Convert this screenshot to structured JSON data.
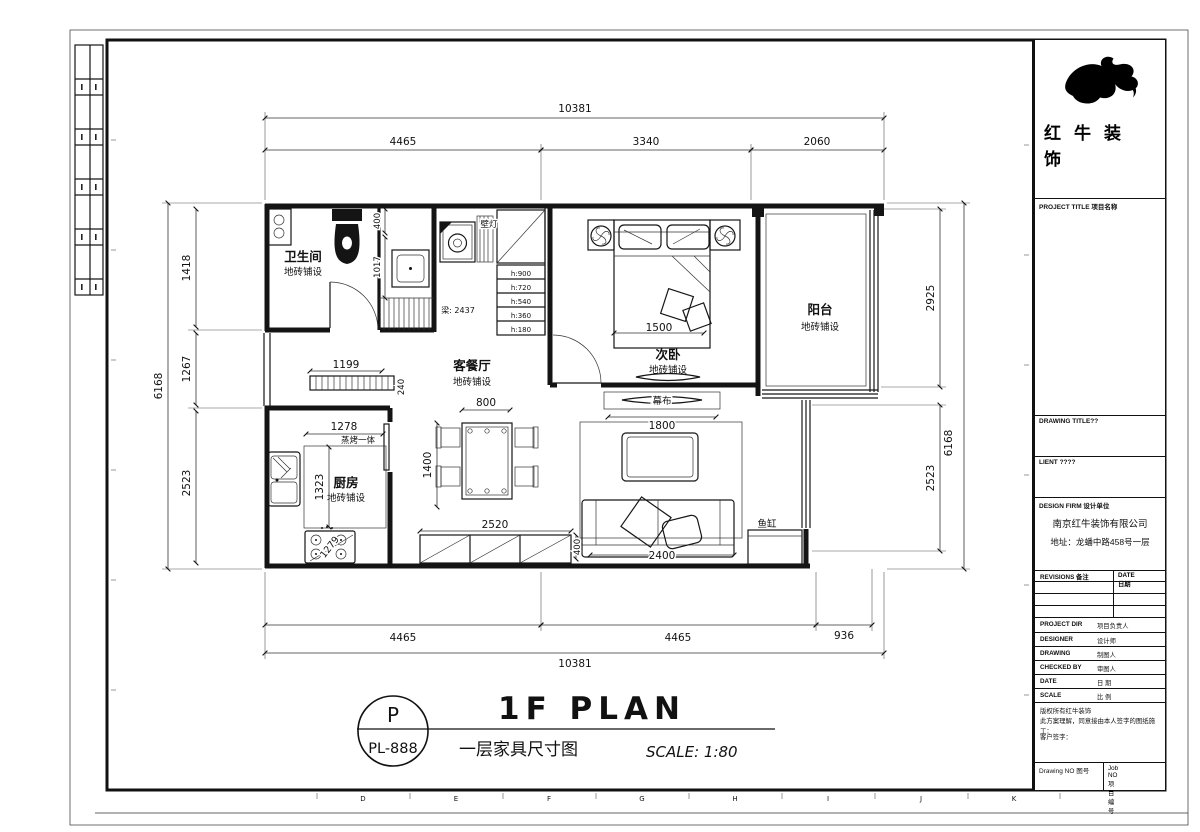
{
  "frame": {
    "bottom_letters": [
      "D",
      "E",
      "F",
      "G",
      "H",
      "I",
      "J",
      "K"
    ]
  },
  "plan": {
    "dims": {
      "top_overall": "10381",
      "top_0": "4465",
      "top_1": "3340",
      "top_2": "2060",
      "bottom_0": "4465",
      "bottom_1": "4465",
      "bottom_2": "936",
      "bottom_overall": "10381",
      "left_overall": "6168",
      "left_0": "1418",
      "left_1": "1267",
      "left_2": "2523",
      "right_0": "2925",
      "right_1": "2523",
      "right_overall": "6168",
      "closet_0": "400",
      "closet_1": "1017",
      "hall": "1199",
      "hall_depth": "240",
      "kitchen_w": "1278",
      "kitchen_h": "1323",
      "stove": "1279",
      "table_w": "800",
      "table_h": "1400",
      "bed_w": "1500",
      "cabinet_w": "2520",
      "cabinet_d": "400",
      "screen_w": "1800",
      "sofa_w": "2400"
    },
    "labels": {
      "bathroom": "卫生间",
      "bathroom_finish": "地砖铺设",
      "living": "客餐厅",
      "living_finish": "地砖铺设",
      "bedroom": "次卧",
      "bedroom_finish": "地砖铺设",
      "balcony": "阳台",
      "balcony_finish": "地砖铺设",
      "kitchen": "厨房",
      "kitchen_finish": "地砖铺设",
      "wall_lamp": "壁灯",
      "beam": "梁: 2437",
      "steam_oven": "蒸烤一体",
      "screen": "幕布",
      "fish_tank": "鱼缸"
    },
    "stairs": [
      "h:900",
      "h:720",
      "h:540",
      "h:360",
      "h:180"
    ]
  },
  "titlebar": {
    "badge_top": "P",
    "badge_bottom": "PL-888",
    "title_en": "1F PLAN",
    "title_cn": "一层家具尺寸图",
    "scale": "SCALE: 1:80"
  },
  "titleblock": {
    "brand": "红牛装饰",
    "project_title": "PROJECT TITLE 项目名称",
    "drawing_title": "DRAWING TITLE??",
    "client": "LIENT ????",
    "design_firm": "DESIGN FIRM 设计单位",
    "firm_name": "南京红牛装饰有限公司",
    "firm_addr": "地址：龙蟠中路458号一层",
    "revisions": "REVISIONS 备注",
    "date_col": "DATE 日期",
    "rows": [
      {
        "en": "PROJECT DIR",
        "cn": "项目负责人"
      },
      {
        "en": "DESIGNER",
        "cn": "设计师"
      },
      {
        "en": "DRAWING",
        "cn": "制图人"
      },
      {
        "en": "CHECKED BY",
        "cn": "审图人"
      },
      {
        "en": "DATE",
        "cn": "日 期"
      },
      {
        "en": "SCALE",
        "cn": "比 例"
      }
    ],
    "disclaimer1": "版权所有红牛装饰",
    "disclaimer2": "此方案理解，同意接由本人签字的图纸施工：",
    "disclaimer3": "客户签字：",
    "drawing_no": "Drawing NO 图号",
    "job_no": "Job NO 项目编号"
  }
}
